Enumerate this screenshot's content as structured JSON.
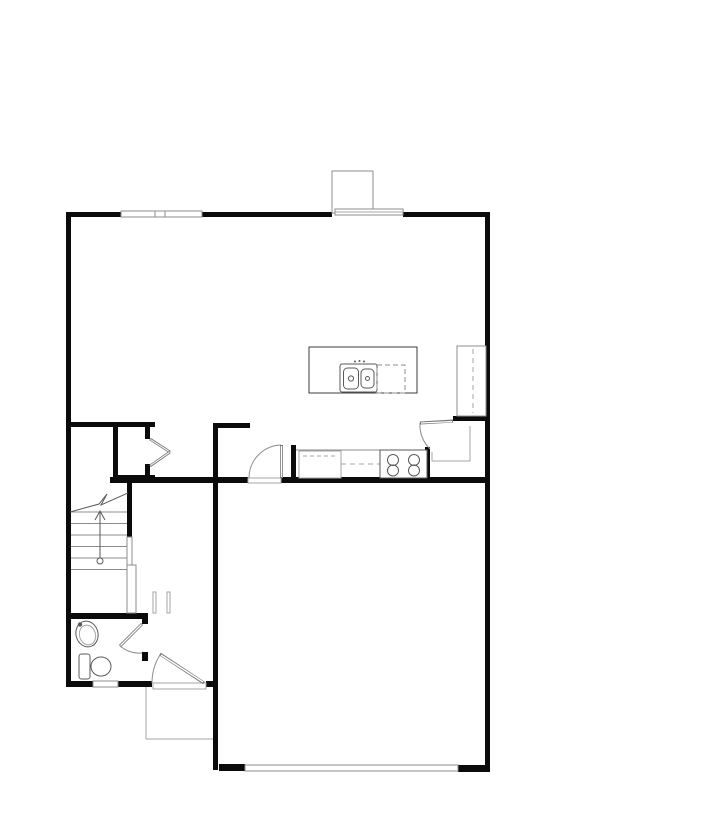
{
  "document": {
    "kind": "architectural-floor-plan",
    "canvas": {
      "width": 720,
      "height": 831,
      "background": "#ffffff"
    }
  },
  "palette": {
    "wall": "#0b0b0b",
    "thin": "#8c8c8c",
    "light": "#a6a6a6",
    "fixture": "#5a5a5a",
    "leaf": "#777777",
    "white": "#ffffff"
  },
  "floorplan": {
    "shapes": [
      {
        "t": "rect",
        "name": "wall-top-left",
        "x": 66,
        "y": 212,
        "w": 55,
        "h": 5,
        "fill": "wall"
      },
      {
        "t": "rect",
        "name": "wall-top-mid",
        "x": 202,
        "y": 212,
        "w": 130,
        "h": 5,
        "fill": "wall"
      },
      {
        "t": "rect",
        "name": "wall-top-right",
        "x": 403,
        "y": 212,
        "w": 87,
        "h": 5,
        "fill": "wall"
      },
      {
        "t": "rect",
        "name": "wall-left",
        "x": 66,
        "y": 212,
        "w": 5,
        "h": 475,
        "fill": "wall"
      },
      {
        "t": "rect",
        "name": "wall-right",
        "x": 485,
        "y": 212,
        "w": 5,
        "h": 560,
        "fill": "wall"
      },
      {
        "t": "rect",
        "name": "wall-hall-north",
        "x": 66,
        "y": 422,
        "w": 89,
        "h": 5,
        "fill": "wall"
      },
      {
        "t": "rect",
        "name": "wall-dining-stub",
        "x": 213,
        "y": 423,
        "w": 37,
        "h": 5,
        "fill": "wall"
      },
      {
        "t": "rect",
        "name": "wall-garage-west",
        "x": 213,
        "y": 423,
        "w": 5,
        "h": 347,
        "fill": "wall"
      },
      {
        "t": "rect",
        "name": "wall-kitchen-south-west",
        "x": 110,
        "y": 477,
        "w": 138,
        "h": 6,
        "fill": "wall"
      },
      {
        "t": "rect",
        "name": "wall-kitchen-south-east",
        "x": 281,
        "y": 477,
        "w": 209,
        "h": 6,
        "fill": "wall"
      },
      {
        "t": "rect",
        "name": "wall-stair-east",
        "x": 127,
        "y": 483,
        "w": 5,
        "h": 54,
        "fill": "wall"
      },
      {
        "t": "rect",
        "name": "wall-closet-west",
        "x": 113,
        "y": 427,
        "w": 5,
        "h": 53,
        "fill": "wall"
      },
      {
        "t": "rect",
        "name": "wall-closet-south",
        "x": 113,
        "y": 475,
        "w": 42,
        "h": 5,
        "fill": "wall"
      },
      {
        "t": "rect",
        "name": "wall-closet-east-upper",
        "x": 145,
        "y": 427,
        "w": 5,
        "h": 12,
        "fill": "wall"
      },
      {
        "t": "rect",
        "name": "wall-closet-east-lower",
        "x": 145,
        "y": 464,
        "w": 5,
        "h": 16,
        "fill": "wall"
      },
      {
        "t": "rect",
        "name": "wall-counter-end",
        "x": 291,
        "y": 445,
        "w": 5,
        "h": 37,
        "fill": "wall"
      },
      {
        "t": "rect",
        "name": "wall-pantry-west",
        "x": 425,
        "y": 447,
        "w": 5,
        "h": 35,
        "fill": "wall"
      },
      {
        "t": "rect",
        "name": "wall-pantry-north",
        "x": 453,
        "y": 416,
        "w": 37,
        "h": 5,
        "fill": "wall"
      },
      {
        "t": "rect",
        "name": "wall-bath-north",
        "x": 66,
        "y": 613,
        "w": 81,
        "h": 6,
        "fill": "wall"
      },
      {
        "t": "rect",
        "name": "wall-bath-east-upper",
        "x": 142,
        "y": 613,
        "w": 6,
        "h": 11,
        "fill": "wall"
      },
      {
        "t": "rect",
        "name": "wall-bath-east-lower",
        "x": 142,
        "y": 652,
        "w": 6,
        "h": 9,
        "fill": "wall"
      },
      {
        "t": "rect",
        "name": "wall-south-a",
        "x": 66,
        "y": 681,
        "w": 27,
        "h": 6,
        "fill": "wall"
      },
      {
        "t": "rect",
        "name": "wall-south-b",
        "x": 118,
        "y": 681,
        "w": 34,
        "h": 6,
        "fill": "wall"
      },
      {
        "t": "rect",
        "name": "wall-south-c",
        "x": 206,
        "y": 681,
        "w": 12,
        "h": 6,
        "fill": "wall"
      },
      {
        "t": "rect",
        "name": "wall-garage-south-west",
        "x": 219,
        "y": 764,
        "w": 26,
        "h": 7,
        "fill": "wall"
      },
      {
        "t": "rect",
        "name": "wall-garage-south-east",
        "x": 458,
        "y": 765,
        "w": 32,
        "h": 7,
        "fill": "wall"
      },
      {
        "t": "rect",
        "name": "window-great-room",
        "x": 121,
        "y": 211,
        "w": 81,
        "h": 6,
        "fill": "white",
        "stroke": "thin"
      },
      {
        "t": "rect",
        "name": "window-great-room-mullion",
        "x": 155,
        "y": 211,
        "w": 10,
        "h": 6,
        "fill": "white",
        "stroke": "thin"
      },
      {
        "t": "rect",
        "name": "fireplace",
        "x": 332,
        "y": 171,
        "w": 41,
        "h": 42,
        "fill": "white",
        "stroke": "thin"
      },
      {
        "t": "rect",
        "name": "window-band-rear",
        "x": 335,
        "y": 209,
        "w": 68,
        "h": 6,
        "fill": "white",
        "stroke": "thin"
      },
      {
        "t": "line",
        "name": "window-band-rear-line",
        "x1": 335,
        "y1": 212,
        "x2": 403,
        "y2": 212,
        "stroke": "light"
      },
      {
        "t": "rect",
        "name": "window-bath",
        "x": 93,
        "y": 681,
        "w": 25,
        "h": 6,
        "fill": "white",
        "stroke": "thin"
      },
      {
        "t": "rect",
        "name": "garage-door",
        "x": 245,
        "y": 765,
        "w": 213,
        "h": 6,
        "fill": "white",
        "stroke": "thin"
      },
      {
        "t": "line",
        "name": "porch-edge-west",
        "x1": 146,
        "y1": 687,
        "x2": 146,
        "y2": 739,
        "stroke": "light"
      },
      {
        "t": "line",
        "name": "porch-edge-south",
        "x1": 146,
        "y1": 739,
        "x2": 213,
        "y2": 739,
        "stroke": "light"
      },
      {
        "t": "rect",
        "name": "front-door-sill",
        "x": 153,
        "y": 683,
        "w": 53,
        "h": 6,
        "fill": "white",
        "stroke": "light"
      },
      {
        "t": "rect",
        "name": "garage-entry-sill",
        "x": 248,
        "y": 478,
        "w": 33,
        "h": 5,
        "fill": "white",
        "stroke": "light"
      },
      {
        "t": "line",
        "name": "stair-tread-1",
        "x1": 71,
        "y1": 512,
        "x2": 127,
        "y2": 512,
        "stroke": "thin"
      },
      {
        "t": "line",
        "name": "stair-tread-2",
        "x1": 71,
        "y1": 523.5,
        "x2": 127,
        "y2": 523.5,
        "stroke": "thin"
      },
      {
        "t": "line",
        "name": "stair-tread-3",
        "x1": 71,
        "y1": 535,
        "x2": 127,
        "y2": 535,
        "stroke": "thin"
      },
      {
        "t": "line",
        "name": "stair-tread-4",
        "x1": 71,
        "y1": 546.5,
        "x2": 127,
        "y2": 546.5,
        "stroke": "thin"
      },
      {
        "t": "line",
        "name": "stair-tread-5",
        "x1": 71,
        "y1": 558,
        "x2": 127,
        "y2": 558,
        "stroke": "thin"
      },
      {
        "t": "line",
        "name": "stair-tread-6",
        "x1": 71,
        "y1": 569.5,
        "x2": 127,
        "y2": 569.5,
        "stroke": "thin"
      },
      {
        "t": "polyline",
        "name": "stair-break-line",
        "pts": "70,512 99,504 107,494 101,505 128,493",
        "stroke": "fixture"
      },
      {
        "t": "line",
        "name": "stair-arrow-line",
        "x1": 100,
        "y1": 558,
        "x2": 100,
        "y2": 512,
        "stroke": "fixture"
      },
      {
        "t": "polyline",
        "name": "stair-arrow-head",
        "pts": "95,520 100,511 105,520",
        "stroke": "fixture"
      },
      {
        "t": "circle",
        "name": "stair-arrow-start",
        "cx": 100,
        "cy": 561,
        "r": 3,
        "fill": "white",
        "stroke": "fixture"
      },
      {
        "t": "rect",
        "name": "stair-half-wall",
        "x": 127,
        "y": 537,
        "w": 5,
        "h": 28,
        "fill": "white",
        "stroke": "thin"
      },
      {
        "t": "rect",
        "name": "stair-base-wall",
        "x": 127,
        "y": 565,
        "w": 9,
        "h": 48,
        "fill": "white",
        "stroke": "thin"
      },
      {
        "t": "rect",
        "name": "hall-nook-wall-west",
        "x": 153,
        "y": 592,
        "w": 3,
        "h": 21,
        "fill": "white",
        "stroke": "light"
      },
      {
        "t": "rect",
        "name": "hall-nook-wall-east",
        "x": 167,
        "y": 592,
        "w": 3,
        "h": 21,
        "fill": "white",
        "stroke": "light"
      },
      {
        "t": "line",
        "name": "counter-front-edge",
        "x1": 296,
        "y1": 450,
        "x2": 425,
        "y2": 450,
        "stroke": "thin"
      },
      {
        "t": "rect",
        "name": "sink-base-cabinet",
        "x": 299,
        "y": 451,
        "w": 42,
        "h": 27,
        "fill": "white",
        "stroke": "light"
      },
      {
        "t": "line",
        "name": "cabinet-dash",
        "x1": 303,
        "y1": 456,
        "x2": 338,
        "y2": 456,
        "stroke": "light",
        "dash": "4,3"
      },
      {
        "t": "line",
        "name": "upper-cabinet-dash",
        "x1": 341,
        "y1": 464,
        "x2": 380,
        "y2": 464,
        "stroke": "light",
        "dash": "5,4"
      },
      {
        "t": "rect",
        "name": "range",
        "x": 380,
        "y": 450,
        "w": 47,
        "h": 28,
        "fill": "white",
        "stroke": "fixture"
      },
      {
        "t": "circle",
        "name": "burner-left-rear",
        "cx": 393,
        "cy": 460,
        "r": 5.5,
        "stroke": "fixture"
      },
      {
        "t": "circle",
        "name": "burner-right-rear",
        "cx": 414,
        "cy": 460,
        "r": 5.5,
        "stroke": "fixture"
      },
      {
        "t": "circle",
        "name": "burner-left-front",
        "cx": 393,
        "cy": 470.5,
        "r": 5.5,
        "stroke": "fixture"
      },
      {
        "t": "circle",
        "name": "burner-right-front",
        "cx": 414,
        "cy": 470.5,
        "r": 5.5,
        "stroke": "fixture"
      },
      {
        "t": "rect",
        "name": "island",
        "x": 309,
        "y": 347,
        "w": 108,
        "h": 46,
        "fill": "white",
        "stroke": "#3c3c3c"
      },
      {
        "t": "rect",
        "name": "island-sink",
        "x": 340,
        "y": 364,
        "w": 37,
        "h": 28,
        "rx": 2,
        "fill": "white",
        "stroke": "fixture"
      },
      {
        "t": "rect",
        "name": "island-sink-basin-left",
        "x": 343.5,
        "y": 368,
        "w": 15,
        "h": 21,
        "rx": 4,
        "stroke": "fixture"
      },
      {
        "t": "rect",
        "name": "island-sink-basin-right",
        "x": 361,
        "y": 369,
        "w": 13,
        "h": 19,
        "rx": 4,
        "stroke": "fixture"
      },
      {
        "t": "circle",
        "name": "island-sink-drain-left",
        "cx": 351,
        "cy": 378.5,
        "r": 2.6,
        "stroke": "fixture"
      },
      {
        "t": "circle",
        "name": "island-sink-drain-right",
        "cx": 367.5,
        "cy": 378.5,
        "r": 2,
        "stroke": "fixture"
      },
      {
        "t": "circle",
        "name": "faucet-dot-1",
        "cx": 355,
        "cy": 361.5,
        "r": 1,
        "fill": "fixture"
      },
      {
        "t": "circle",
        "name": "faucet-dot-2",
        "cx": 359.5,
        "cy": 361,
        "r": 1,
        "fill": "fixture"
      },
      {
        "t": "circle",
        "name": "faucet-dot-3",
        "cx": 364,
        "cy": 361.5,
        "r": 1,
        "fill": "fixture"
      },
      {
        "t": "rect",
        "name": "dishwasher",
        "x": 377,
        "y": 365,
        "w": 28,
        "h": 28,
        "stroke": "thin",
        "dash": "5,3"
      },
      {
        "t": "rect",
        "name": "refrigerator",
        "x": 457,
        "y": 346,
        "w": 29,
        "h": 70,
        "fill": "white",
        "stroke": "thin"
      },
      {
        "t": "line",
        "name": "refrigerator-dash",
        "x1": 473,
        "y1": 349,
        "x2": 473,
        "y2": 413,
        "stroke": "light",
        "dash": "5,4"
      },
      {
        "t": "polyline",
        "name": "pantry-shelves",
        "pts": "432,452 432,461 470,461 470,426",
        "stroke": "light"
      },
      {
        "t": "path",
        "name": "front-door-arc",
        "d": "M160,655 A52,52 0 0 0 152,683",
        "stroke": "thin"
      },
      {
        "t": "line",
        "name": "front-door-leaf",
        "x1": 204,
        "y1": 683,
        "x2": 160,
        "y2": 654,
        "stroke": "leaf",
        "sw": 3
      },
      {
        "t": "line",
        "name": "front-door-leaf-core",
        "x1": 203,
        "y1": 682,
        "x2": 161,
        "y2": 655,
        "stroke": "white",
        "sw": 1.4
      },
      {
        "t": "path",
        "name": "garage-entry-door-arc",
        "d": "M281,445 A33,33 0 0 0 249,478",
        "stroke": "thin"
      },
      {
        "t": "line",
        "name": "garage-entry-door-leaf",
        "x1": 281.5,
        "y1": 478,
        "x2": 281.5,
        "y2": 445,
        "stroke": "leaf",
        "sw": 3
      },
      {
        "t": "line",
        "name": "garage-entry-door-leaf-core",
        "x1": 281.5,
        "y1": 477,
        "x2": 281.5,
        "y2": 446,
        "stroke": "white",
        "sw": 1.4
      },
      {
        "t": "path",
        "name": "bathroom-door-arc",
        "d": "M120,646 A31,31 0 0 0 142,653",
        "stroke": "thin"
      },
      {
        "t": "line",
        "name": "bathroom-door-leaf",
        "x1": 142,
        "y1": 624,
        "x2": 120,
        "y2": 646,
        "stroke": "leaf",
        "sw": 3
      },
      {
        "t": "line",
        "name": "bathroom-door-leaf-core",
        "x1": 141.5,
        "y1": 624.5,
        "x2": 120.5,
        "y2": 645.5,
        "stroke": "white",
        "sw": 1.3
      },
      {
        "t": "path",
        "name": "pantry-door-arc",
        "d": "M420,423 A33,33 0 0 0 430,449",
        "stroke": "thin"
      },
      {
        "t": "line",
        "name": "pantry-door-leaf",
        "x1": 453,
        "y1": 421,
        "x2": 420,
        "y2": 423,
        "stroke": "leaf",
        "sw": 3
      },
      {
        "t": "line",
        "name": "pantry-door-leaf-core",
        "x1": 452,
        "y1": 421.5,
        "x2": 421,
        "y2": 423,
        "stroke": "white",
        "sw": 1.3
      },
      {
        "t": "line",
        "name": "closet-door-upper",
        "x1": 150,
        "y1": 439,
        "x2": 170,
        "y2": 452,
        "stroke": "leaf",
        "sw": 2.6
      },
      {
        "t": "line",
        "name": "closet-door-upper-core",
        "x1": 150.5,
        "y1": 439.5,
        "x2": 169.5,
        "y2": 451.7,
        "stroke": "white",
        "sw": 1
      },
      {
        "t": "line",
        "name": "closet-door-lower",
        "x1": 150,
        "y1": 466,
        "x2": 170,
        "y2": 452,
        "stroke": "leaf",
        "sw": 2.6
      },
      {
        "t": "line",
        "name": "closet-door-lower-core",
        "x1": 150.5,
        "y1": 465.5,
        "x2": 169.5,
        "y2": 452.3,
        "stroke": "white",
        "sw": 1
      },
      {
        "t": "rect",
        "name": "toilet-tank",
        "x": 79,
        "y": 654,
        "w": 11,
        "h": 25,
        "rx": 2.5,
        "fill": "white",
        "stroke": "fixture"
      },
      {
        "t": "ellipse",
        "name": "toilet-bowl",
        "cx": 101,
        "cy": 666.5,
        "rx": 10,
        "ry": 9.5,
        "fill": "white",
        "stroke": "fixture"
      },
      {
        "t": "ellipse",
        "name": "sink-pedestal-outer",
        "cx": 87,
        "cy": 634,
        "rx": 11,
        "ry": 13,
        "rot": -15,
        "fill": "white",
        "stroke": "fixture"
      },
      {
        "t": "ellipse",
        "name": "sink-pedestal-inner",
        "cx": 87.5,
        "cy": 635,
        "rx": 8,
        "ry": 10,
        "rot": -15,
        "stroke": "light"
      },
      {
        "t": "circle",
        "name": "sink-faucet",
        "cx": 80,
        "cy": 624.5,
        "r": 2.2,
        "fill": "fixture"
      }
    ]
  }
}
